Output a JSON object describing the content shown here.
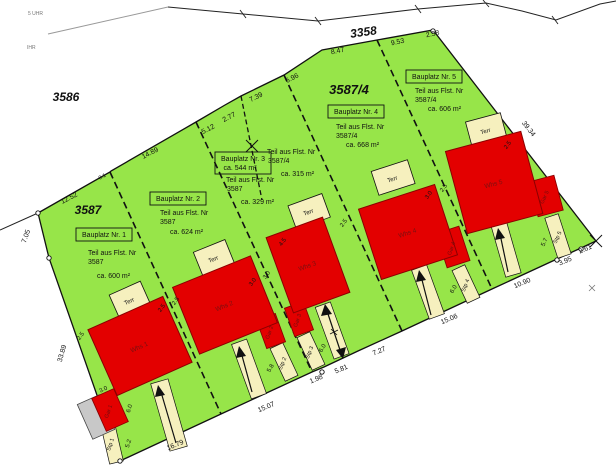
{
  "plan": {
    "corner_texts": [
      "5 UHR",
      "IHR"
    ],
    "parcel_labels": {
      "p3586": "3586",
      "p3587": "3587",
      "p3587_4": "3587/4",
      "p3358": "3358"
    },
    "plots": [
      {
        "title": "Bauplatz Nr. 1",
        "teil": "Teil aus Flst. Nr",
        "flst": "3587",
        "area": "ca. 600 m²",
        "house": "Whs 1",
        "terrace": "Terr",
        "garage": "Gar 1",
        "parking": "Stp 1"
      },
      {
        "title": "Bauplatz Nr. 2",
        "teil": "Teil aus Flst. Nr",
        "flst": "3587",
        "area": "ca. 624 m²",
        "house": "Whs 2",
        "terrace": "Terr",
        "garage": "Gar 2",
        "parking": "Stp 2"
      },
      {
        "title": "Bauplatz Nr. 3",
        "title_area": "ca. 544 m²",
        "teil": "Teil aus Flst. Nr",
        "flst": "3587",
        "area": "ca. 329 m²",
        "teil2": "Teil aus Flst. Nr",
        "flst2": "3587/4",
        "area2": "ca. 315 m²",
        "house": "Whs 3",
        "terrace": "Terr",
        "garage": "Gar 3",
        "parking": "Stp 3"
      },
      {
        "title": "Bauplatz Nr. 4",
        "teil": "Teil aus Flst. Nr",
        "flst": "3587/4",
        "area": "ca. 668 m²",
        "house": "Whs 4",
        "terrace": "Terr",
        "garage": "Gar 4",
        "parking": "Stp 4"
      },
      {
        "title": "Bauplatz Nr. 5",
        "teil": "Teil aus Flst. Nr",
        "flst": "3587/4",
        "area": "ca. 606 m²",
        "house": "Whs 5",
        "terrace": "Terr",
        "garage": "Gar 5",
        "parking": "Stp 5"
      }
    ],
    "dims_top": [
      "12.52",
      "0.1",
      "14.89",
      "5.12",
      "2.77",
      "7.39",
      "6.96",
      "8.47",
      "9.53",
      "2.58"
    ],
    "dims_bottom": [
      "16.79",
      "15.07",
      "1.98",
      "5.81",
      "7.27",
      "15.06",
      "10.90",
      "3.95",
      "2.61"
    ],
    "dims_left": [
      "7.05",
      "33.89"
    ],
    "dims_right": [
      "39.34"
    ],
    "setbacks": [
      "2.5",
      "2.5",
      "2.5",
      "3.0",
      "3.0",
      "4.5",
      "2.5",
      "3.0",
      "2.5",
      "2.5"
    ],
    "garage1_dims": [
      "3.0",
      "6.0"
    ],
    "parking_dims": [
      "5.2",
      "5.8",
      "6.0",
      "6.0",
      "5.7"
    ],
    "colors": {
      "plot_green": "#97E549",
      "building_red": "#E30000",
      "accessory_cream": "#F6F0BE",
      "existing_gray": "#C8C8C8"
    }
  }
}
